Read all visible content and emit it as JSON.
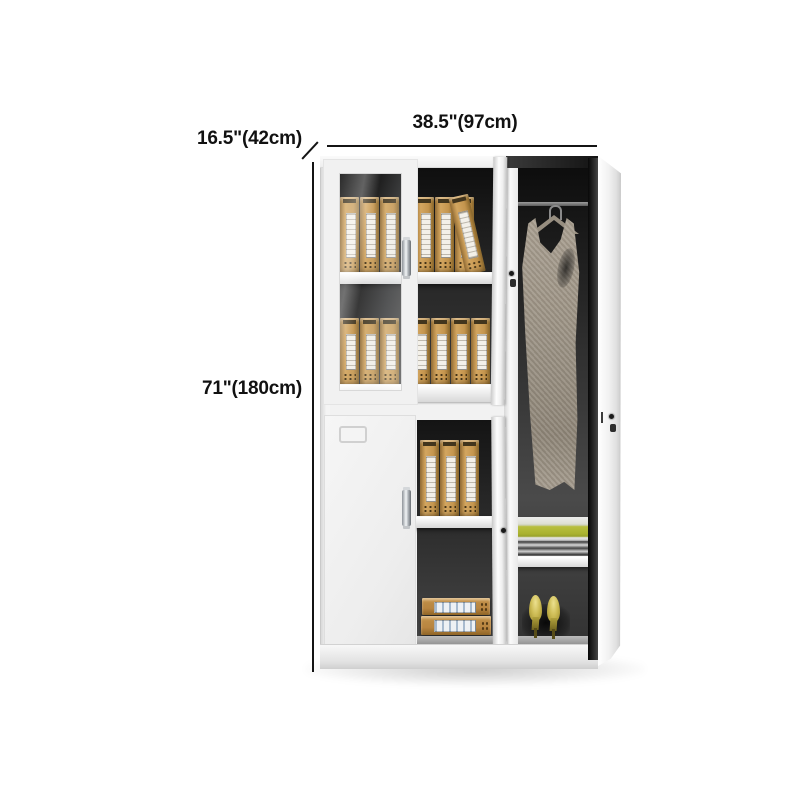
{
  "annotations": {
    "width_label": "38.5\"(97cm)",
    "depth_label": "16.5\"(42cm)",
    "height_label": "71\"(180cm)"
  },
  "colors": {
    "background": "#ffffff",
    "annotation_text": "#111111",
    "cabinet_white": "#f2f2f2",
    "interior_dark": "#2a2a2a",
    "binder_tan": "#c4954e",
    "binder_label": "#f3f0e9",
    "dress_taupe": "#9a9183",
    "clothes_green": "#aab22f",
    "shoe_gold": "#cdbc55",
    "handle_chrome": "#aab0b5"
  },
  "scene": {
    "description_items": [
      "glass-door-cabinet",
      "file-binders",
      "hanging-dress",
      "folded-clothes",
      "high-heel-shoes",
      "document-boxes",
      "door-locks"
    ],
    "binder_groups": [
      {
        "name": "upper-shelf-1-behind-glass",
        "left": 340,
        "top": 197,
        "count": 3,
        "w": 19,
        "h": 76
      },
      {
        "name": "upper-shelf-1-open",
        "left": 415,
        "top": 197,
        "count": 3,
        "w": 19,
        "h": 76
      },
      {
        "name": "upper-shelf-1-tilted",
        "left": 466,
        "top": 194,
        "count": 1,
        "w": 20,
        "h": 79,
        "tilt": -13
      },
      {
        "name": "upper-shelf-2-behind-glass",
        "left": 340,
        "top": 318,
        "count": 3,
        "w": 19,
        "h": 67
      },
      {
        "name": "upper-shelf-2-open",
        "left": 411,
        "top": 318,
        "count": 4,
        "w": 19,
        "h": 67
      },
      {
        "name": "lower-shelf",
        "left": 420,
        "top": 440,
        "count": 3,
        "w": 19,
        "h": 77
      }
    ],
    "document_boxes": 2,
    "shoes": 2
  }
}
